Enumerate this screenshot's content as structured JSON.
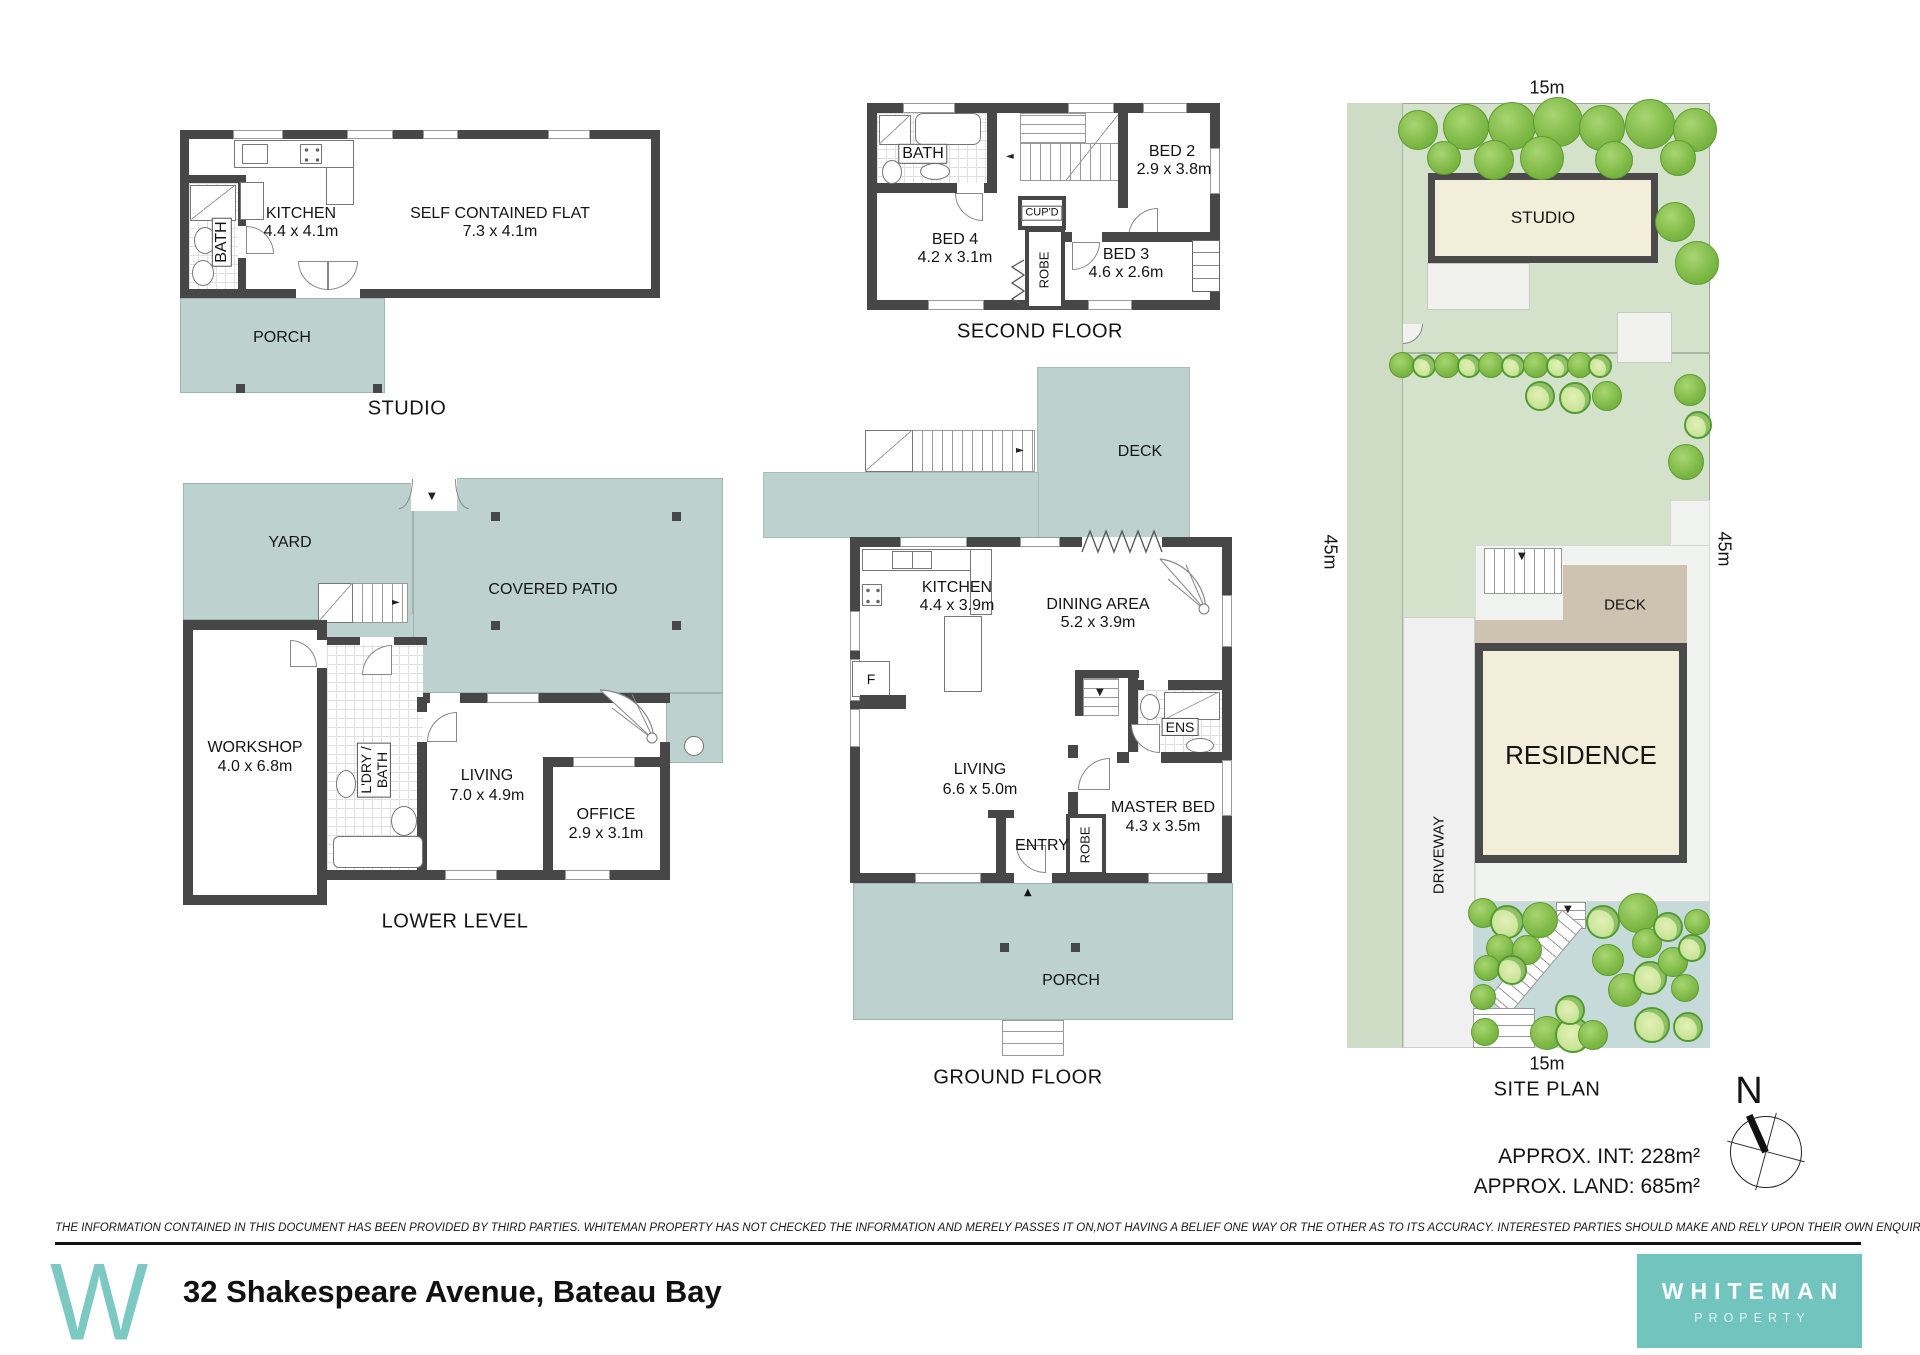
{
  "studio_plan": {
    "caption": "STUDIO",
    "porch": "PORCH",
    "bath": "BATH",
    "kitchen": {
      "name": "KITCHEN",
      "dims": "4.4 x 4.1m"
    },
    "flat": {
      "name": "SELF CONTAINED FLAT",
      "dims": "7.3 x 4.1m"
    }
  },
  "second_floor": {
    "caption": "SECOND FLOOR",
    "bath": "BATH",
    "cupd": "CUP'D",
    "robe": "ROBE",
    "bed2": {
      "name": "BED 2",
      "dims": "2.9 x 3.8m"
    },
    "bed3": {
      "name": "BED 3",
      "dims": "4.6 x 2.6m"
    },
    "bed4": {
      "name": "BED 4",
      "dims": "4.2 x 3.1m"
    }
  },
  "ground_floor": {
    "caption": "GROUND FLOOR",
    "deck": "DECK",
    "porch": "PORCH",
    "entry": "ENTRY",
    "ens": "ENS",
    "robe": "ROBE",
    "fridge": "F",
    "kitchen": {
      "name": "KITCHEN",
      "dims": "4.4 x 3.9m"
    },
    "dining": {
      "name": "DINING AREA",
      "dims": "5.2 x 3.9m"
    },
    "living": {
      "name": "LIVING",
      "dims": "6.6 x 5.0m"
    },
    "master": {
      "name": "MASTER BED",
      "dims": "4.3 x 3.5m"
    }
  },
  "lower_level": {
    "caption": "LOWER LEVEL",
    "yard": "YARD",
    "patio": "COVERED PATIO",
    "ldry1": "L'DRY /",
    "ldry2": "BATH",
    "workshop": {
      "name": "WORKSHOP",
      "dims": "4.0 x 6.8m"
    },
    "living": {
      "name": "LIVING",
      "dims": "7.0 x 4.9m"
    },
    "office": {
      "name": "OFFICE",
      "dims": "2.9 x 3.1m"
    }
  },
  "site_plan": {
    "caption": "SITE PLAN",
    "studio": "STUDIO",
    "deck": "DECK",
    "residence": "RESIDENCE",
    "driveway": "DRIVEWAY",
    "dim_top": "15m",
    "dim_bottom": "15m",
    "dim_left": "45m",
    "d_right": "45m",
    "trees_top": [
      {
        "x": 1418,
        "y": 130,
        "d": 40,
        "s": 1
      },
      {
        "x": 1466,
        "y": 127,
        "d": 46,
        "s": 1
      },
      {
        "x": 1512,
        "y": 126,
        "d": 48,
        "s": 1
      },
      {
        "x": 1558,
        "y": 122,
        "d": 50,
        "s": 1
      },
      {
        "x": 1602,
        "y": 128,
        "d": 46,
        "s": 1
      },
      {
        "x": 1650,
        "y": 124,
        "d": 50,
        "s": 1
      },
      {
        "x": 1695,
        "y": 130,
        "d": 44,
        "s": 1
      },
      {
        "x": 1444,
        "y": 158,
        "d": 34,
        "s": 1
      },
      {
        "x": 1494,
        "y": 160,
        "d": 40,
        "s": 1
      },
      {
        "x": 1542,
        "y": 158,
        "d": 44,
        "s": 1
      },
      {
        "x": 1614,
        "y": 160,
        "d": 38,
        "s": 1
      },
      {
        "x": 1678,
        "y": 158,
        "d": 36,
        "s": 1
      },
      {
        "x": 1675,
        "y": 222,
        "d": 40,
        "s": 1
      },
      {
        "x": 1697,
        "y": 263,
        "d": 44,
        "s": 1
      },
      {
        "x": 1690,
        "y": 390,
        "d": 32,
        "s": 1
      },
      {
        "x": 1698,
        "y": 425,
        "d": 28,
        "s": 2
      },
      {
        "x": 1686,
        "y": 462,
        "d": 36,
        "s": 1
      }
    ],
    "shrub_row": [
      {
        "x": 1402,
        "y": 365,
        "d": 26,
        "s": 1
      },
      {
        "x": 1424,
        "y": 366,
        "d": 24,
        "s": 2
      },
      {
        "x": 1447,
        "y": 365,
        "d": 26,
        "s": 1
      },
      {
        "x": 1469,
        "y": 366,
        "d": 24,
        "s": 2
      },
      {
        "x": 1491,
        "y": 365,
        "d": 26,
        "s": 1
      },
      {
        "x": 1513,
        "y": 366,
        "d": 24,
        "s": 2
      },
      {
        "x": 1536,
        "y": 365,
        "d": 26,
        "s": 1
      },
      {
        "x": 1558,
        "y": 366,
        "d": 24,
        "s": 2
      },
      {
        "x": 1580,
        "y": 365,
        "d": 26,
        "s": 1
      },
      {
        "x": 1600,
        "y": 366,
        "d": 24,
        "s": 2
      },
      {
        "x": 1540,
        "y": 396,
        "d": 30,
        "s": 2
      },
      {
        "x": 1575,
        "y": 398,
        "d": 32,
        "s": 2
      },
      {
        "x": 1607,
        "y": 396,
        "d": 30,
        "s": 1
      }
    ],
    "garden_trees": [
      {
        "x": 1483,
        "y": 913,
        "d": 30,
        "s": 1
      },
      {
        "x": 1507,
        "y": 922,
        "d": 34,
        "s": 2
      },
      {
        "x": 1540,
        "y": 920,
        "d": 36,
        "s": 1
      },
      {
        "x": 1500,
        "y": 948,
        "d": 28,
        "s": 1
      },
      {
        "x": 1527,
        "y": 950,
        "d": 30,
        "s": 1
      },
      {
        "x": 1487,
        "y": 968,
        "d": 26,
        "s": 1
      },
      {
        "x": 1512,
        "y": 970,
        "d": 30,
        "s": 2
      },
      {
        "x": 1483,
        "y": 997,
        "d": 26,
        "s": 1
      },
      {
        "x": 1485,
        "y": 1032,
        "d": 28,
        "s": 1
      },
      {
        "x": 1547,
        "y": 1033,
        "d": 34,
        "s": 1
      },
      {
        "x": 1573,
        "y": 1035,
        "d": 36,
        "s": 2
      },
      {
        "x": 1570,
        "y": 1010,
        "d": 30,
        "s": 2
      },
      {
        "x": 1603,
        "y": 922,
        "d": 34,
        "s": 2
      },
      {
        "x": 1608,
        "y": 960,
        "d": 32,
        "s": 1
      },
      {
        "x": 1593,
        "y": 1035,
        "d": 30,
        "s": 1
      },
      {
        "x": 1625,
        "y": 990,
        "d": 34,
        "s": 1
      },
      {
        "x": 1638,
        "y": 913,
        "d": 40,
        "s": 1
      },
      {
        "x": 1647,
        "y": 943,
        "d": 30,
        "s": 1
      },
      {
        "x": 1650,
        "y": 978,
        "d": 34,
        "s": 2
      },
      {
        "x": 1652,
        "y": 1025,
        "d": 36,
        "s": 2
      },
      {
        "x": 1668,
        "y": 927,
        "d": 30,
        "s": 2
      },
      {
        "x": 1673,
        "y": 962,
        "d": 30,
        "s": 1
      },
      {
        "x": 1685,
        "y": 988,
        "d": 28,
        "s": 1
      },
      {
        "x": 1692,
        "y": 948,
        "d": 28,
        "s": 2
      },
      {
        "x": 1697,
        "y": 922,
        "d": 26,
        "s": 1
      },
      {
        "x": 1688,
        "y": 1027,
        "d": 30,
        "s": 2
      }
    ]
  },
  "summary": {
    "int": "APPROX. INT: 228m²",
    "land": "APPROX. LAND: 685m²"
  },
  "compass": {
    "north": "N"
  },
  "footer": {
    "disclaimer": "THE INFORMATION CONTAINED IN THIS DOCUMENT HAS BEEN PROVIDED BY THIRD PARTIES. WHITEMAN PROPERTY HAS NOT CHECKED THE INFORMATION AND MERELY PASSES IT ON,NOT HAVING A BELIEF ONE WAY OR THE OTHER AS TO ITS ACCURACY. INTERESTED PARTIES SHOULD MAKE AND RELY UPON THEIR OWN ENQUIRIES.",
    "address": "32 Shakespeare Avenue, Bateau Bay",
    "logo": "W",
    "brand1": "WHITEMAN",
    "brand2": "PROPERTY"
  }
}
